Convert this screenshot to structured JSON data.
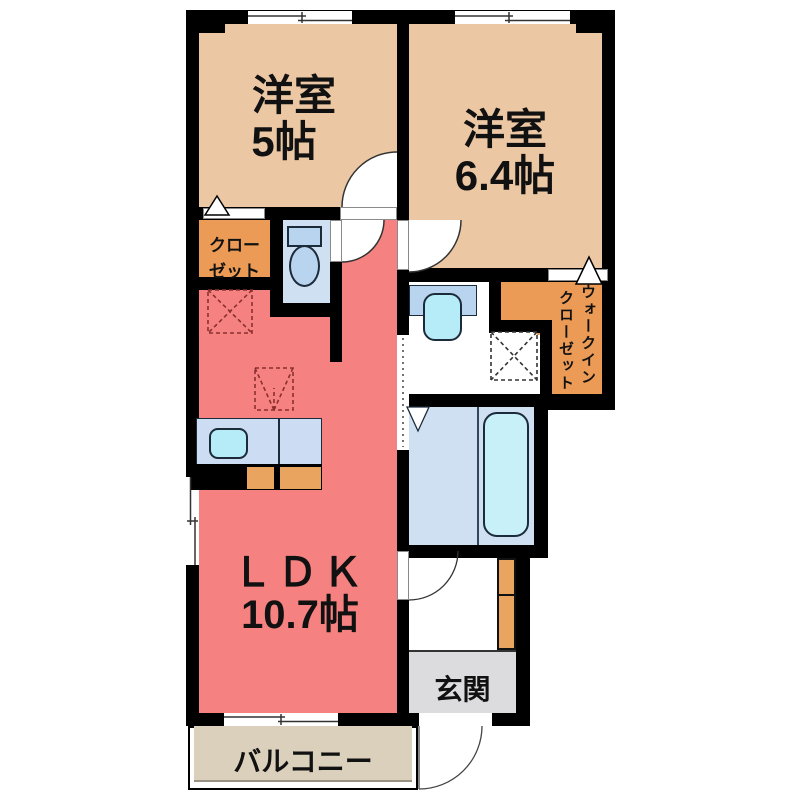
{
  "plan": {
    "bedroom1": {
      "name": "洋室",
      "size": "5帖"
    },
    "bedroom2": {
      "name": "洋室",
      "size": "6.4帖"
    },
    "ldk": {
      "name": "ＬＤＫ",
      "size": "10.7帖"
    },
    "closet": {
      "name_line1": "クロー",
      "name_line2": "ゼット"
    },
    "wic": {
      "name_col1": "ウォークイン",
      "name_col2": "クローゼット"
    },
    "entrance": {
      "name": "玄関"
    },
    "balcony": {
      "name": "バルコニー"
    }
  },
  "colors": {
    "wall": "#000000",
    "bedroom": "#ecc7a4",
    "ldk": "#f58280",
    "closet": "#eb9b55",
    "balcony": "#dbd0bc",
    "entrance": "#dcdcde",
    "wetroom": "#cfe0f3",
    "fixture": "#b9d4ee",
    "basin": "#b5ecf8",
    "counter": "#ccdcf2",
    "cabinet": "#e9a45f"
  },
  "icons": {
    "toilet": "tank-and-oval-bowl",
    "kitchen-sink": "rounded-rect-basin",
    "vanity-basin": "rounded-rect-basin",
    "bathtub": "rounded-rect-tub",
    "door-swing": "quarter-circle-arc",
    "folding-door": "white-triangle",
    "sliding-window": "offset-double-line",
    "appliance-space": "dashed-box-with-x"
  }
}
